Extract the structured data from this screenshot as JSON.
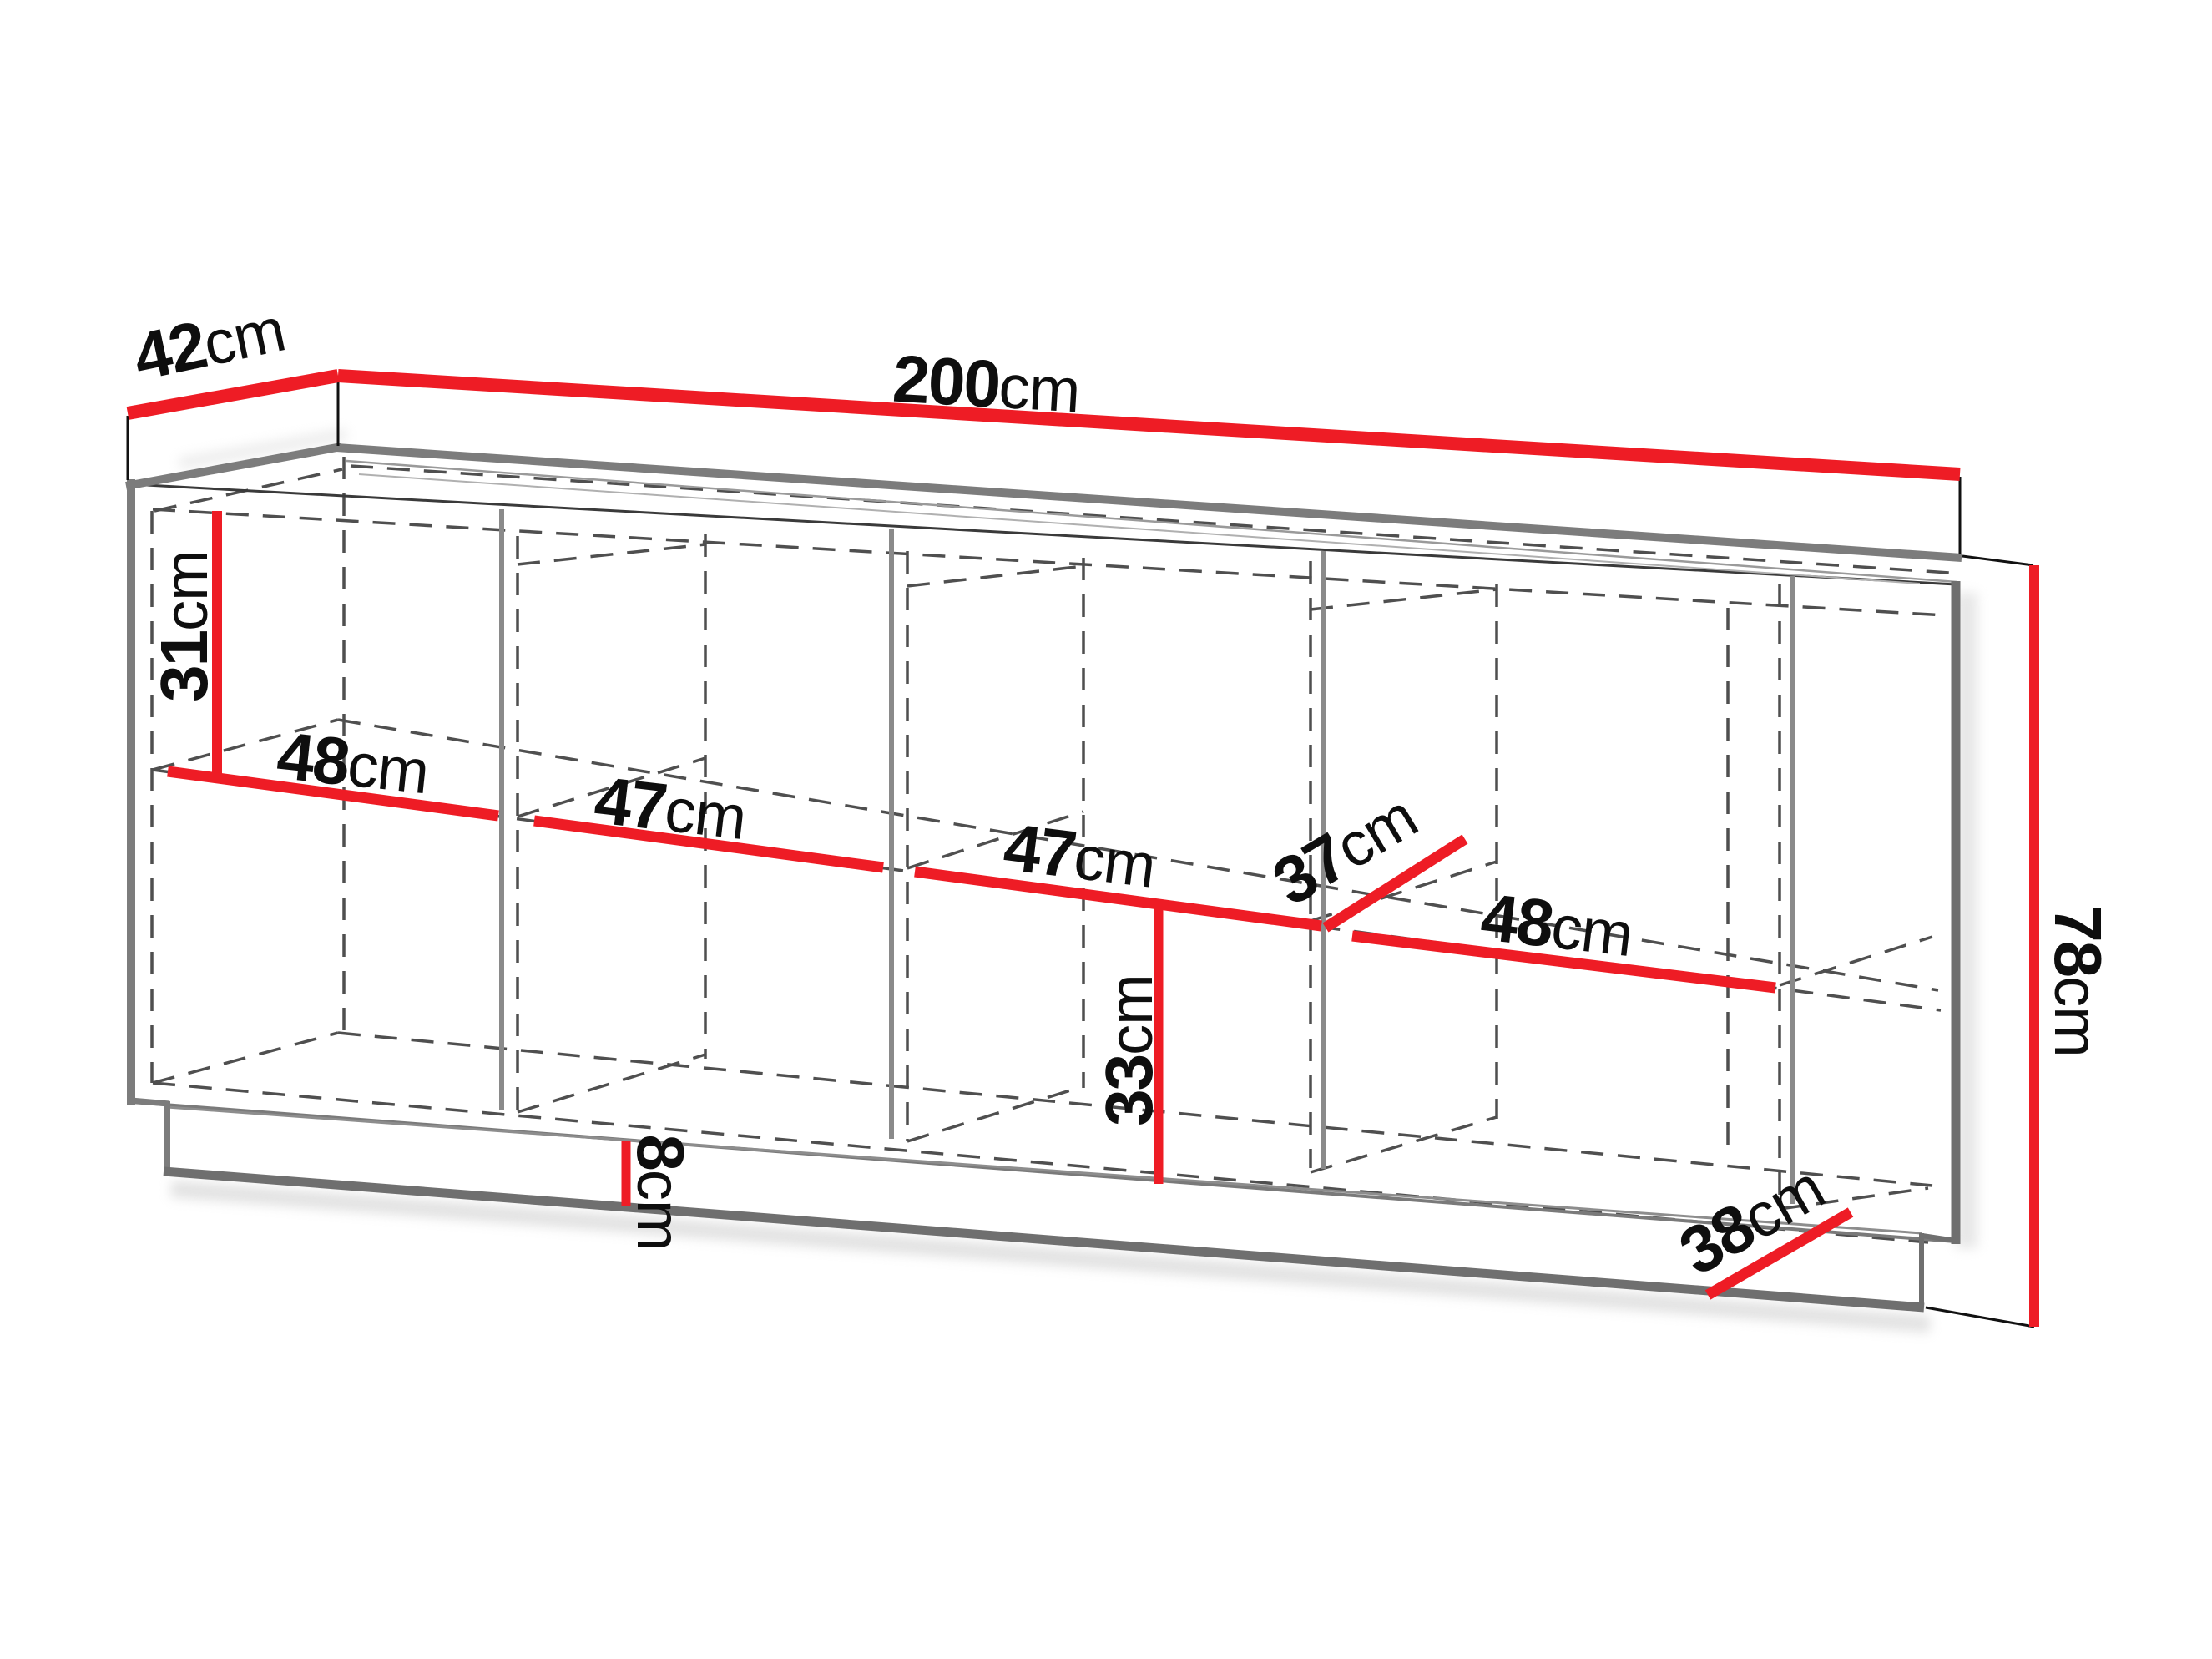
{
  "diagram": {
    "type": "furniture-dimension-drawing",
    "unit": "cm",
    "accent_red": "#ee1c25",
    "edge_gray": "#7c7c7c",
    "hidden_line_gray": "#4f4f4f",
    "measurements": [
      {
        "id": "top-depth",
        "value": "42",
        "unit": "cm"
      },
      {
        "id": "total-width",
        "value": "200",
        "unit": "cm"
      },
      {
        "id": "upper-clearance",
        "value": "31",
        "unit": "cm"
      },
      {
        "id": "section-1-width",
        "value": "48",
        "unit": "cm"
      },
      {
        "id": "section-2-width",
        "value": "47",
        "unit": "cm"
      },
      {
        "id": "section-3-width",
        "value": "47",
        "unit": "cm"
      },
      {
        "id": "shelf-depth",
        "value": "37",
        "unit": "cm"
      },
      {
        "id": "section-4-width",
        "value": "48",
        "unit": "cm"
      },
      {
        "id": "total-height",
        "value": "78",
        "unit": "cm"
      },
      {
        "id": "lower-clearance",
        "value": "33",
        "unit": "cm"
      },
      {
        "id": "plinth-height",
        "value": "8",
        "unit": "cm"
      },
      {
        "id": "bottom-depth",
        "value": "38",
        "unit": "cm"
      }
    ]
  }
}
